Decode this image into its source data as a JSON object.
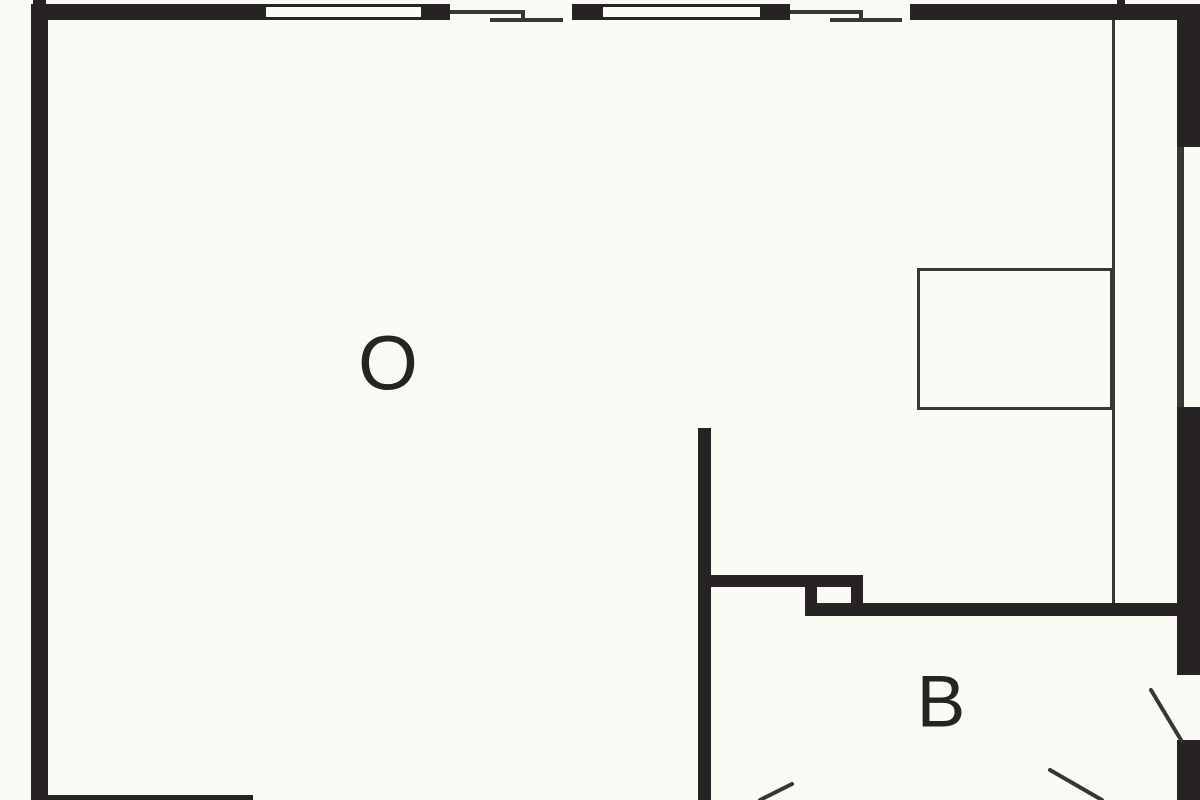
{
  "drawing": {
    "kind": "architectural floor plan (cropped)",
    "rooms": [
      {
        "id": "room-o",
        "label": "O"
      },
      {
        "id": "room-b",
        "label": "B"
      }
    ]
  },
  "labels": {
    "room_o": "O",
    "room_b": "B"
  },
  "colors": {
    "ink": "#272223",
    "paper": "#fbfbf6",
    "line": "#3a3536"
  }
}
